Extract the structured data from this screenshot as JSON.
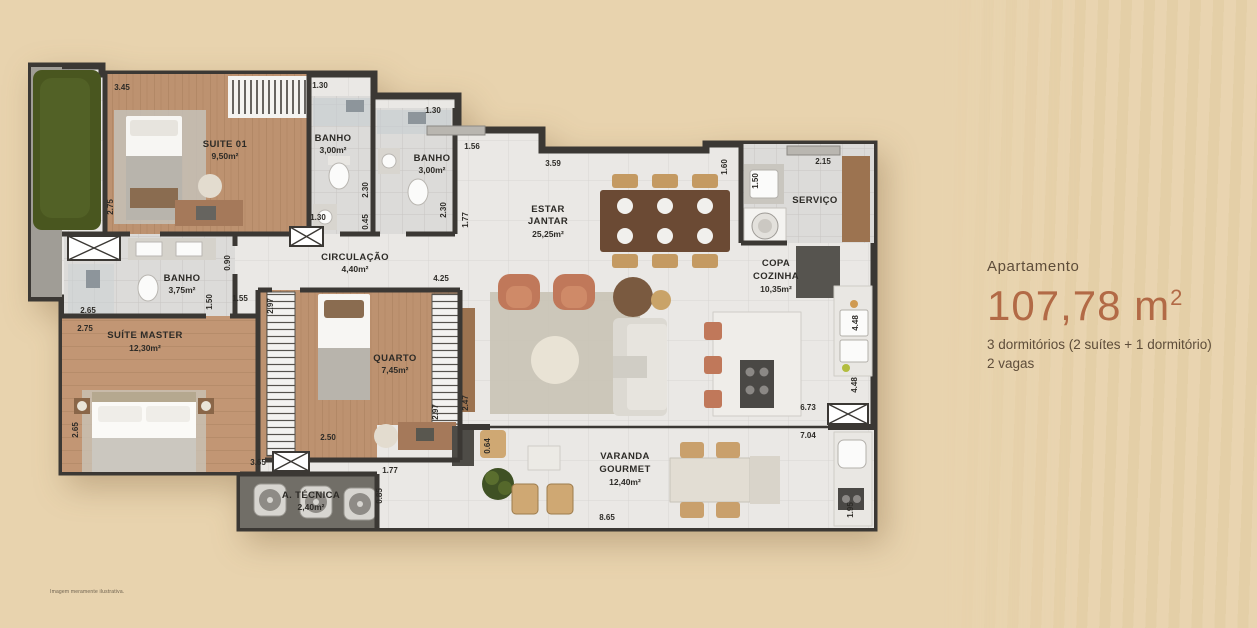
{
  "panel": {
    "label": "Apartamento",
    "area": "107,78 m",
    "area_sup": "2",
    "line1": "3 dormitórios (2 suítes + 1 dormitório)",
    "line2": "2 vagas"
  },
  "disclaimer": "Imagem meramente ilustrativa.",
  "rooms": {
    "suite01": {
      "name": "SUITE 01",
      "area": "9,50m²"
    },
    "banho1": {
      "name": "BANHO",
      "area": "3,00m²"
    },
    "banho2": {
      "name": "BANHO",
      "area": "3,00m²"
    },
    "circulacao": {
      "name": "CIRCULAÇÃO",
      "area": "4,40m²"
    },
    "banho_master": {
      "name": "BANHO",
      "area": "3,75m²"
    },
    "suite_master": {
      "name": "SUÍTE MASTER",
      "area": "12,30m²"
    },
    "quarto": {
      "name": "QUARTO",
      "area": "7,45m²"
    },
    "estar_l1": "ESTAR",
    "estar_l2": "JANTAR",
    "estar_area": "25,25m²",
    "servico": {
      "name": "SERVIÇO"
    },
    "copa_l1": "COPA",
    "copa_l2": "COZINHA",
    "copa_area": "10,35m²",
    "varanda_l1": "VARANDA",
    "varanda_l2": "GOURMET",
    "varanda_area": "12,40m²",
    "atecnica": {
      "name": "A. TÉCNICA",
      "area": "2,40m²"
    }
  },
  "dims": {
    "suite01_w": "3.45",
    "suite01_h": "2.75",
    "banho1_w": "1.30",
    "banho1_h": "2.30",
    "banho1_b": "1.30",
    "banho1_s": "0.45",
    "banho2_w": "1.30",
    "banho2_h": "2.30",
    "entry_w": "1.56",
    "estar_w": "3.59",
    "estar_h": "1.77",
    "servico_l": "1.60",
    "servico_w": "2.15",
    "servico_t": "1.50",
    "circ_h": "0.90",
    "bmaster_w": "2.65",
    "bmaster_h": "1.50",
    "bmaster_d": "1.55",
    "closet_h": "2.97",
    "smaster_t": "2.75",
    "smaster_l": "2.65",
    "smaster_b": "3.65",
    "quarto_t": "4.25",
    "quarto_r": "2.97",
    "quarto_rr": "2.47",
    "quarto_b": "2.50",
    "var_l": "1.77",
    "var_s": "0.85",
    "var_c": "0.64",
    "copa_w": "6.73",
    "var_w": "7.04",
    "copa_h": "4.48",
    "copa_h2": "4.48",
    "var_r": "1.95",
    "var_b": "8.65"
  },
  "colors": {
    "background": "#e8d3ae",
    "wall": "#3b3834",
    "wood_floor": "#bb906c",
    "tile": "#d9d8d6",
    "accent_terracotta": "#b26a46",
    "hedge_green": "#49561f"
  }
}
